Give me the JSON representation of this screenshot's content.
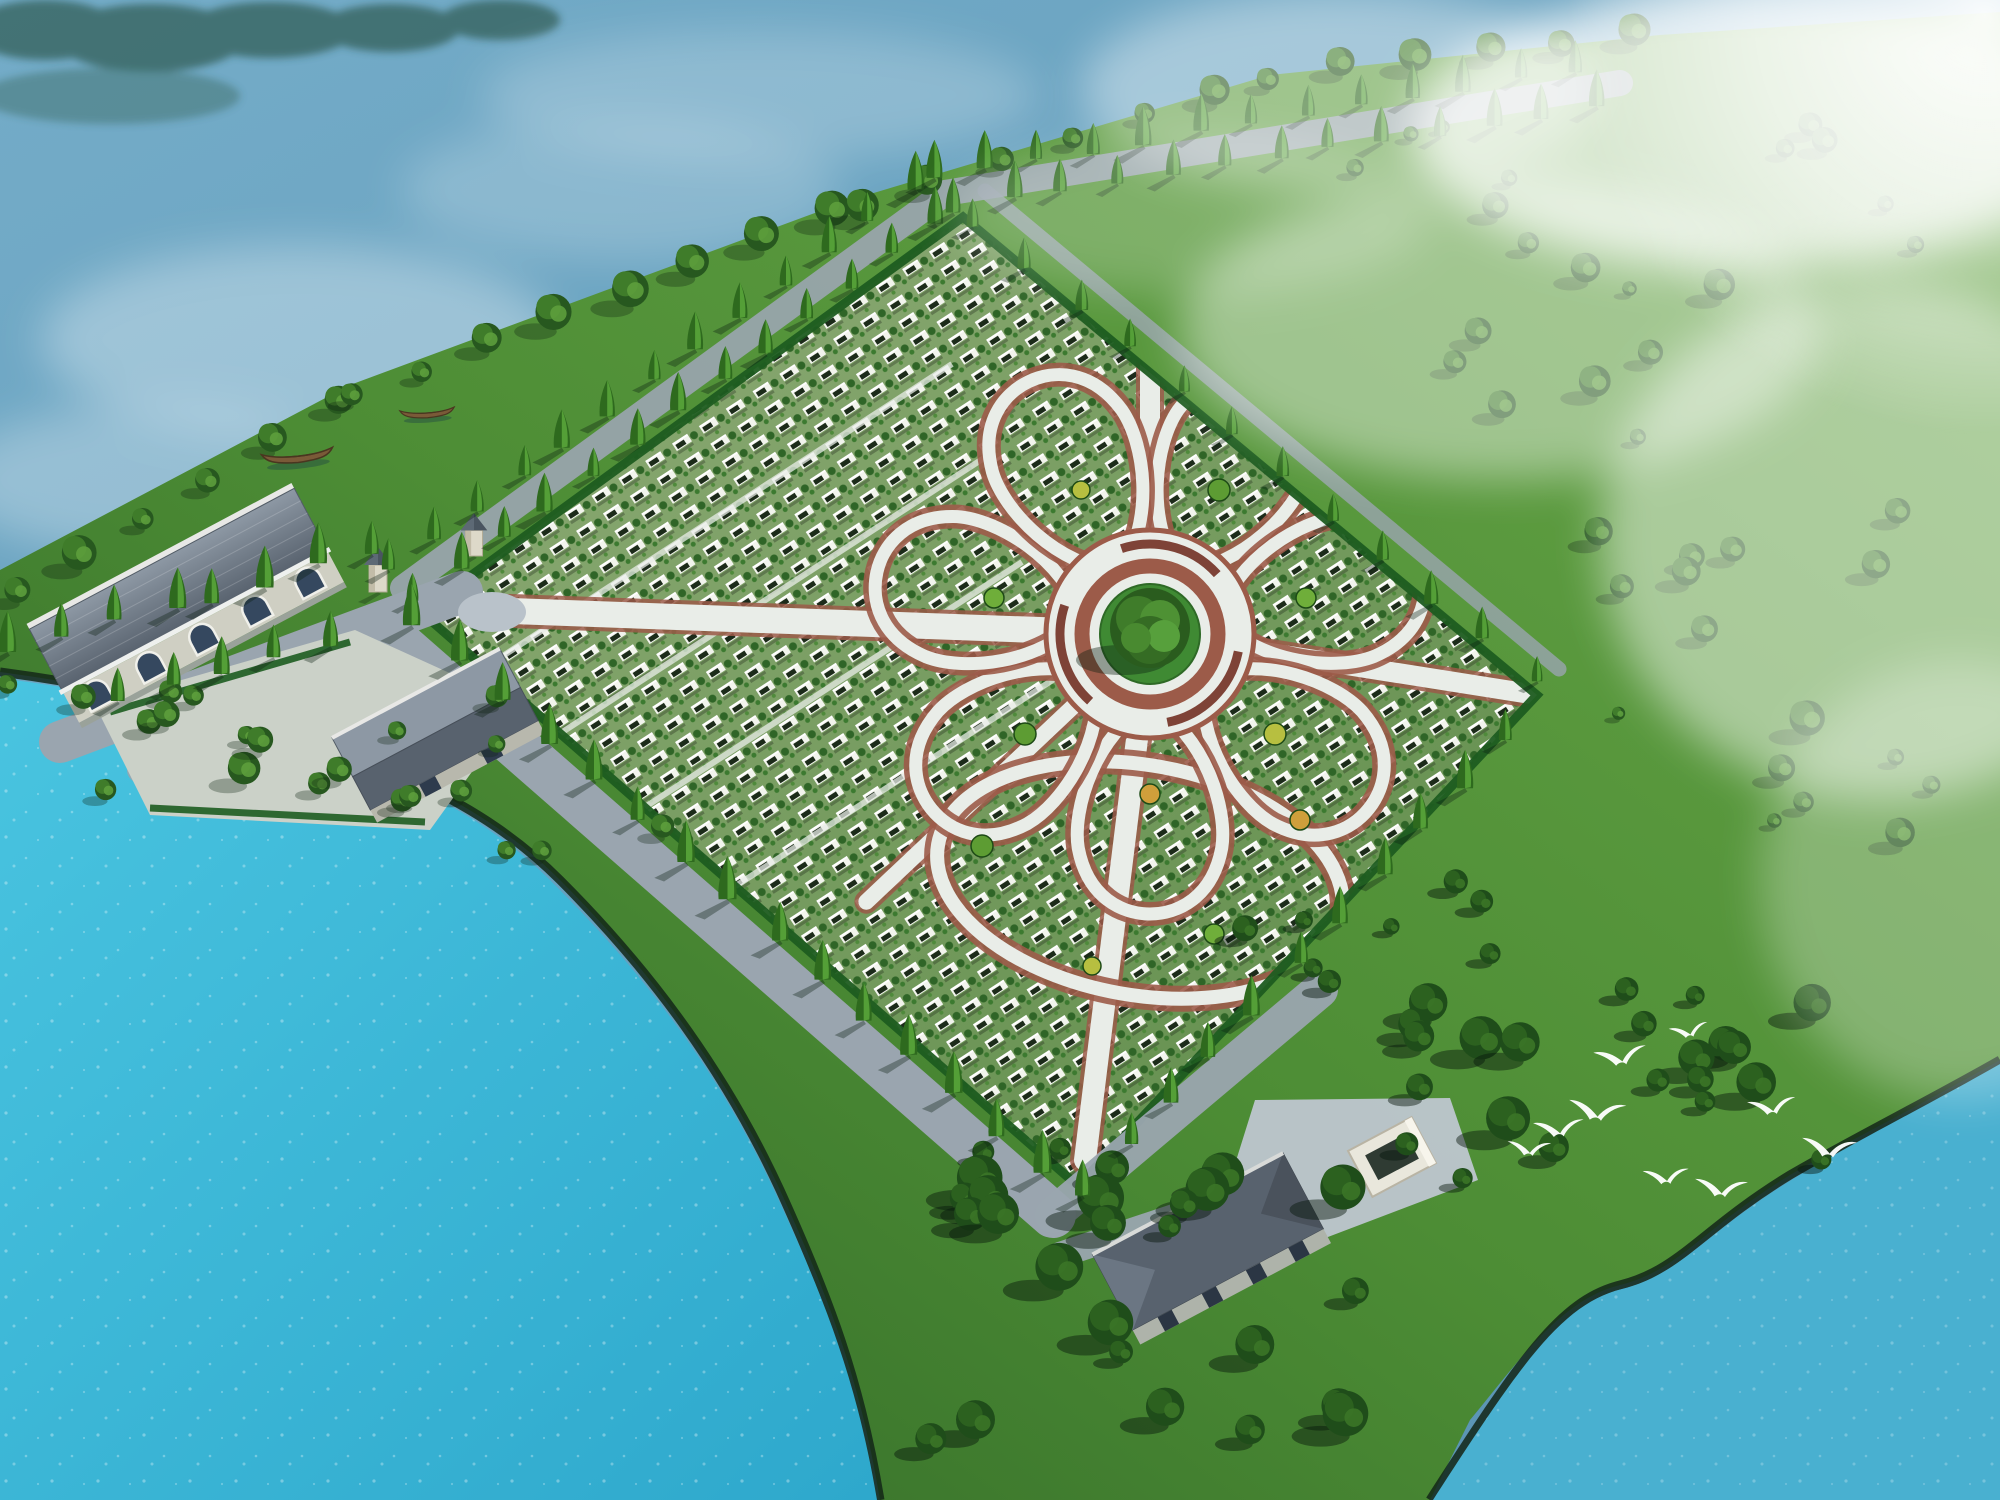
{
  "scene": {
    "type": "aerial-architectural-rendering",
    "subject": "flower-shaped lakeside memorial park master plan",
    "view": "birds-eye-isometric",
    "lighting": "sunny with drifting white mist",
    "text_on_screen": "none"
  },
  "palette": {
    "water_top": "#74acc8",
    "water_deep": "#5b95b5",
    "water_bright": "#3fbcdc",
    "water_bright2": "#49b0d0",
    "shore_dark": "#132718",
    "grass_light": "#6aa849",
    "grass": "#4d8d35",
    "grass_dark": "#2e6526",
    "forest_dark": "#1d4b1c",
    "field_light": "#8fac77",
    "field_dark": "#5e8c49",
    "grave_white": "#f2f4ed",
    "grave_dark": "#1c2b1a",
    "plant_green": "#2f6527",
    "road": "#9aa5af",
    "road_light": "#b9c2ca",
    "paving": "#e9ede8",
    "brick": "#9c5b49",
    "bench": "#7e4337",
    "hedge": "#1d5c20",
    "cone_dark": "#2e6a1e",
    "cone_light": "#5aa83c",
    "tree_dark": "#27581f",
    "tree_mid": "#3f7c2a",
    "tree_light": "#5d9e3c",
    "forest_tree": "#1f4d1a",
    "roof": "#77828f",
    "roof_dark": "#58626e",
    "roof_light": "#8d98a4",
    "wall": "#cfcfc3",
    "window": "#35485f",
    "frame": "#f0f0ea",
    "boat": "#7a5a38",
    "boat_dark": "#4a3620",
    "bird": "#ffffff",
    "mist": "#ffffff"
  },
  "field": {
    "corners": "963,217 1537,695 1078,1186 421,612",
    "grave_row_angle_deg": -33,
    "section_lines": [
      [
        432,
        702,
        952,
        364
      ],
      [
        464,
        796,
        984,
        458
      ],
      [
        502,
        900,
        1022,
        562
      ],
      [
        548,
        1008,
        1068,
        670
      ],
      [
        1185,
        1136,
        1705,
        798
      ]
    ]
  },
  "flower": {
    "cx": 1150,
    "cy": 634,
    "petal_count": 7,
    "angle_offset_deg": 25.7,
    "petal_tip_r": 280,
    "petal_inner_r": 70,
    "petal_half_width": 78,
    "spokes": [
      {
        "dx": 0,
        "dy": -1,
        "len": 300,
        "w": 20
      },
      {
        "dx": 387,
        "dy": 61,
        "len": 392,
        "w": 20
      },
      {
        "dx": -65,
        "dy": 526,
        "len": 530,
        "w": 22
      },
      {
        "dx": -668,
        "dy": -24,
        "len": 668,
        "w": 26
      },
      {
        "dx": -284,
        "dy": 268,
        "len": 390,
        "w": 16
      }
    ],
    "loop": {
      "cx": -10,
      "cy": 246,
      "rx": 205,
      "ry": 115,
      "rot": 10
    },
    "roundabout": {
      "outer_r": 104,
      "brick_r": 68,
      "bench_r": 90,
      "grass_r": 50,
      "tree_r": 40
    },
    "bushes": [
      {
        "x": 37,
        "y": -77,
        "r": 10
      },
      {
        "x": 83,
        "y": -19,
        "r": 9
      },
      {
        "x": 66,
        "y": 53,
        "r": 10
      },
      {
        "x": 0,
        "y": 85,
        "r": 9
      },
      {
        "x": -66,
        "y": 53,
        "r": 10
      },
      {
        "x": -83,
        "y": -19,
        "r": 9
      },
      {
        "x": -37,
        "y": -77,
        "r": 8
      },
      {
        "x": 69,
        "y": -144,
        "r": 11
      },
      {
        "x": 156,
        "y": -36,
        "r": 10
      },
      {
        "x": 125,
        "y": 100,
        "r": 11
      },
      {
        "x": 0,
        "y": 160,
        "r": 10
      },
      {
        "x": -125,
        "y": 100,
        "r": 11
      },
      {
        "x": -156,
        "y": -36,
        "r": 10
      },
      {
        "x": -69,
        "y": -144,
        "r": 9
      },
      {
        "x": 150,
        "y": 186,
        "r": 10
      },
      {
        "x": -168,
        "y": 212,
        "r": 11
      },
      {
        "x": 64,
        "y": 300,
        "r": 10
      },
      {
        "x": -58,
        "y": 332,
        "r": 9
      },
      {
        "x": 196,
        "y": 300,
        "r": 9
      }
    ],
    "bush_colors": [
      "#6fae3a",
      "#b7bf40",
      "#cf9f3b",
      "#5d9c33"
    ]
  },
  "vegetation": {
    "tree_lines": [
      {
        "name": "shore-round-trees",
        "type": "round",
        "pts": [
          [
            20,
            600
          ],
          [
            350,
            402
          ],
          [
            860,
            212
          ],
          [
            1270,
            82
          ],
          [
            1650,
            42
          ]
        ],
        "spacing": 74,
        "smin": 0.9,
        "smax": 1.7,
        "seed": 11
      },
      {
        "name": "avenue-cypress-row-upper",
        "type": "cone",
        "pts": [
          [
            391,
            572
          ],
          [
            933,
            177
          ],
          [
            1617,
            63
          ]
        ],
        "spacing": 54,
        "smin": 0.85,
        "smax": 1.2,
        "seed": 21
      },
      {
        "name": "avenue-cypress-row-lower",
        "type": "cone",
        "pts": [
          [
            415,
            604
          ],
          [
            957,
            209
          ],
          [
            1623,
            103
          ]
        ],
        "spacing": 54,
        "smin": 0.8,
        "smax": 1.15,
        "seed": 31
      },
      {
        "name": "left-strip-cypress",
        "type": "cone",
        "pts": [
          [
            10,
            648
          ],
          [
            210,
            600
          ],
          [
            380,
            548
          ]
        ],
        "spacing": 56,
        "smin": 0.9,
        "smax": 1.25,
        "seed": 41
      },
      {
        "name": "perimeter-cypress-southwest",
        "type": "cone",
        "pts": [
          [
            414,
            622
          ],
          [
            1070,
            1196
          ]
        ],
        "spacing": 60,
        "smin": 0.95,
        "smax": 1.3,
        "seed": 51
      },
      {
        "name": "perimeter-cypress-southeast",
        "type": "cone",
        "pts": [
          [
            1085,
            1193
          ],
          [
            1544,
            702
          ]
        ],
        "spacing": 62,
        "smin": 0.85,
        "smax": 1.2,
        "seed": 61
      },
      {
        "name": "perimeter-cypress-northeast",
        "type": "cone",
        "pts": [
          [
            975,
            225
          ],
          [
            1548,
            692
          ]
        ],
        "spacing": 66,
        "smin": 0.7,
        "smax": 1.0,
        "seed": 71
      },
      {
        "name": "courtyard-cypress",
        "type": "cone",
        "pts": [
          [
            120,
            700
          ],
          [
            330,
            642
          ]
        ],
        "spacing": 54,
        "smin": 0.9,
        "smax": 1.2,
        "seed": 81
      },
      {
        "name": "lower-shore-rounds",
        "type": "round",
        "pts": [
          [
            10,
            690
          ],
          [
            260,
            748
          ],
          [
            430,
            812
          ]
        ],
        "spacing": 80,
        "smin": 0.8,
        "smax": 1.3,
        "seed": 91
      }
    ],
    "tree_patches": [
      {
        "name": "southeast-forest-a",
        "type": "forest",
        "x": 930,
        "y": 1150,
        "w": 470,
        "h": 300,
        "count": 26,
        "smin": 0.9,
        "smax": 2.2,
        "seed": 101
      },
      {
        "name": "southeast-forest-b",
        "type": "forest",
        "x": 1400,
        "y": 980,
        "w": 430,
        "h": 215,
        "count": 22,
        "smin": 0.8,
        "smax": 2.0,
        "seed": 111
      },
      {
        "name": "southeast-forest-c",
        "type": "forest",
        "x": 1240,
        "y": 870,
        "w": 260,
        "h": 130,
        "count": 8,
        "smin": 0.7,
        "smax": 1.4,
        "seed": 116
      },
      {
        "name": "northeast-meadow",
        "type": "round",
        "x": 1320,
        "y": 130,
        "w": 620,
        "h": 330,
        "count": 20,
        "smin": 0.6,
        "smax": 1.5,
        "seed": 121
      },
      {
        "name": "east-meadow",
        "type": "round",
        "x": 1580,
        "y": 500,
        "w": 390,
        "h": 400,
        "count": 16,
        "smin": 0.6,
        "smax": 1.7,
        "seed": 131
      },
      {
        "name": "courtyard-grove",
        "type": "round",
        "x": 60,
        "y": 690,
        "w": 380,
        "h": 130,
        "count": 8,
        "smin": 0.8,
        "smax": 1.5,
        "seed": 141
      },
      {
        "name": "entry-grove",
        "type": "round",
        "x": 430,
        "y": 700,
        "w": 260,
        "h": 160,
        "count": 6,
        "smin": 0.7,
        "smax": 1.3,
        "seed": 151
      }
    ]
  },
  "wildlife": {
    "birds": [
      {
        "x": 1622,
        "y": 1058,
        "s": 1.15,
        "r": -8
      },
      {
        "x": 1598,
        "y": 1113,
        "s": 1.25,
        "r": 6
      },
      {
        "x": 1560,
        "y": 1130,
        "s": 1.1,
        "r": -4
      },
      {
        "x": 1530,
        "y": 1150,
        "s": 0.95,
        "r": 3
      },
      {
        "x": 1773,
        "y": 1108,
        "s": 1.05,
        "r": -6
      },
      {
        "x": 1830,
        "y": 1150,
        "s": 1.2,
        "r": 5
      },
      {
        "x": 1667,
        "y": 1178,
        "s": 1.0,
        "r": -3
      },
      {
        "x": 1722,
        "y": 1190,
        "s": 1.15,
        "r": 4
      },
      {
        "x": 1690,
        "y": 1032,
        "s": 0.85,
        "r": -10
      }
    ]
  },
  "boats": [
    {
      "x": 297,
      "y": 451,
      "s": 1.05,
      "r": -6
    },
    {
      "x": 427,
      "y": 409,
      "s": 0.8,
      "r": -4
    }
  ],
  "buildings": {
    "main_ceremony_hall": {
      "arched_windows": 5
    },
    "side_hall": 1,
    "south_service_hall": 1,
    "entrance_gate_towers": 2,
    "white_courtyard_enclosure": 1
  }
}
